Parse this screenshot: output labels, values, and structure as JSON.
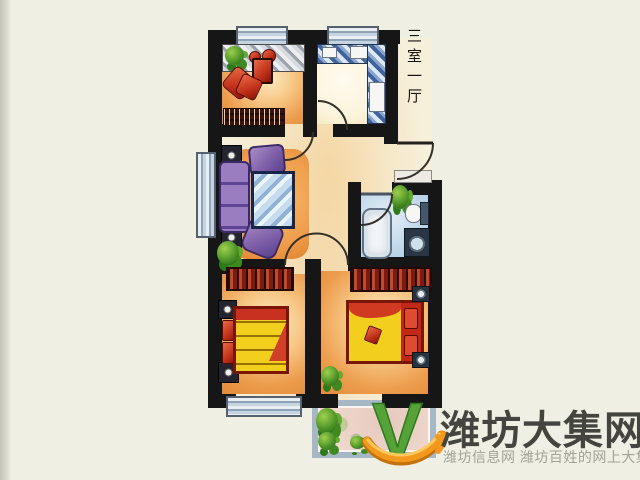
{
  "scene": {
    "background": "#f0efe3",
    "plan_label": "三室一厅"
  },
  "watermark": {
    "brand": "潍坊大集网",
    "tagline": "潍坊信息网 潍坊百姓的网上大集",
    "logo_letter": "V",
    "brand_color": "#454540",
    "tagline_color": "#a2a29a",
    "logo_green": "#55a238",
    "logo_orange": "#f39a1e"
  },
  "palette": {
    "wall": "#161616",
    "window_frame": "#55616e",
    "bedroom_floor_orange": "#ec9c4c",
    "kitchen_counter_blue": "#3f639c",
    "bathroom_floor_blue": "#b3cfe5",
    "balcony_floor_pink": "#eed7cb",
    "bed_yellow": "#f2cf1c",
    "bed_red": "#c22818",
    "sofa_purple": "#7e5fa8",
    "dresser_hatch_red": "#7a1d10"
  },
  "rooms": [
    "bedroom-top-left",
    "kitchen",
    "living-room",
    "foyer",
    "bathroom",
    "bedroom-bottom-left",
    "bedroom-bottom-right",
    "balcony"
  ]
}
